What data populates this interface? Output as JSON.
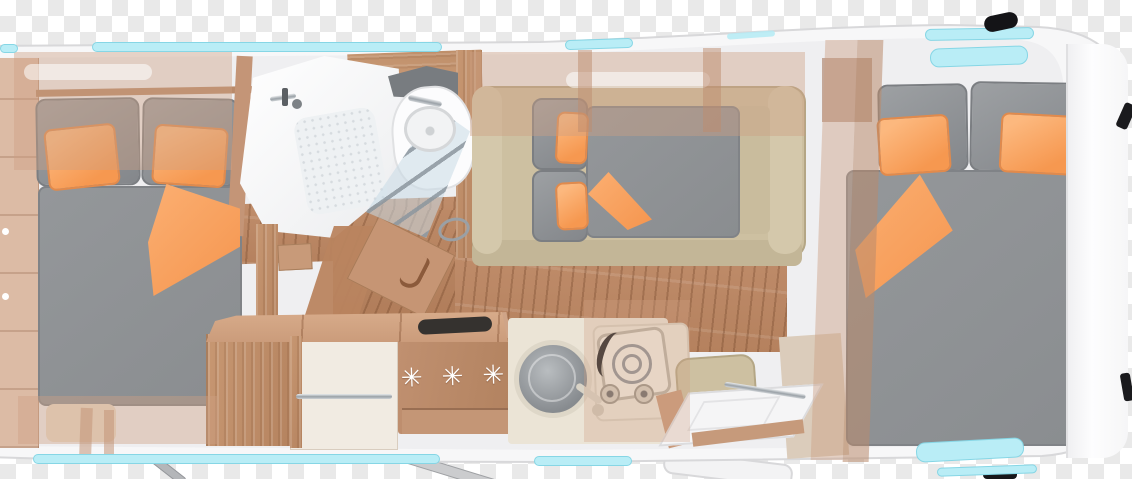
{
  "scene": {
    "type": "caravan floor plan, top view 3D render",
    "background": "transparent checkerboard",
    "vehicle": "caravan interior layout with two bedrooms, washroom, kitchen and lounge"
  },
  "appliances": {
    "fridge_freezer_symbols": "✳ ✳ ✳"
  },
  "palette": {
    "accent_orange": "#f8a162",
    "upholstery_gray": "#8f9295",
    "seating_beige": "#cdc0a1",
    "wood_mid": "#c2916f",
    "wood_floor": "#bf8c6b",
    "window_cyan": "#b9edf6",
    "body_white": "#f7f7f8"
  },
  "rooms": {
    "left_bedroom": "double bed, two orange pillows, folded orange throw, wardrobes",
    "washroom": "shower with folding glass door, washbasin, mirror shelf, door handle",
    "kitchen": "fridge-freezer with snowflake symbols, round sink, two-burner hob, wardrobe with rail",
    "lounge_dinette": "made-up drop-down bed with orange pillows over beige bench seating",
    "right_bedroom": "large double bed, two orange pillows, folded orange throw"
  },
  "windows": {
    "skylights": 2,
    "side_window_strips": 5
  }
}
